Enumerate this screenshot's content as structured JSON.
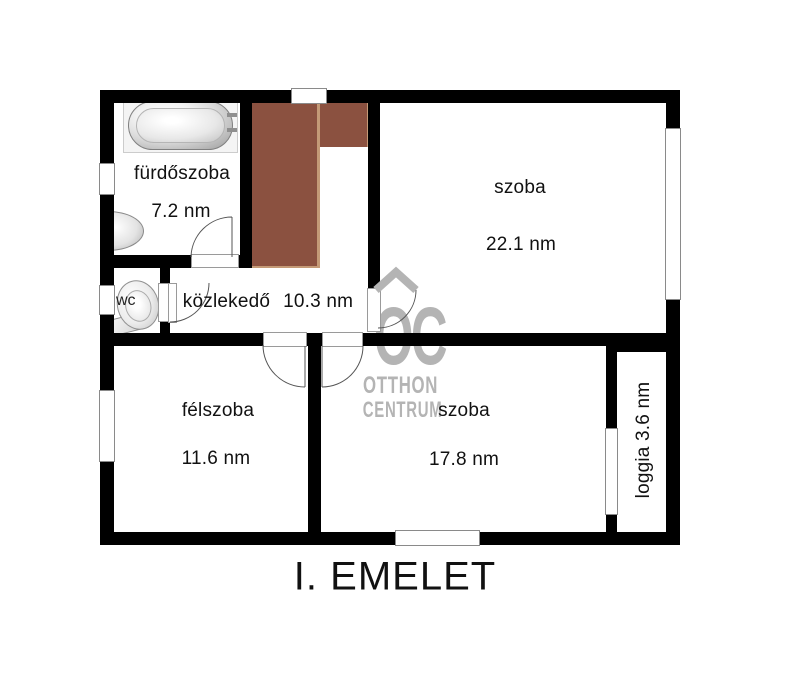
{
  "title": "I. EMELET",
  "rooms": {
    "bathroom": {
      "label": "fürdőszoba",
      "area": "7.2 nm"
    },
    "room_large": {
      "label": "szoba",
      "area": "22.1 nm"
    },
    "hallway": {
      "label": "közlekedő",
      "area": "10.3 nm"
    },
    "wc": {
      "label": "wc"
    },
    "half_room": {
      "label": "félszoba",
      "area": "11.6 nm"
    },
    "room_medium": {
      "label": "szoba",
      "area": "17.8 nm"
    },
    "loggia": {
      "label": "loggia 3.6 nm"
    }
  },
  "watermark": {
    "letters": "OC",
    "line1": "OTTHON",
    "line2": "CENTRUM"
  },
  "colors": {
    "wall": "#000000",
    "stair": "#8B5140",
    "stair_edge": "#C49A77",
    "wm": "#b4b4b4",
    "line": "#555555"
  }
}
